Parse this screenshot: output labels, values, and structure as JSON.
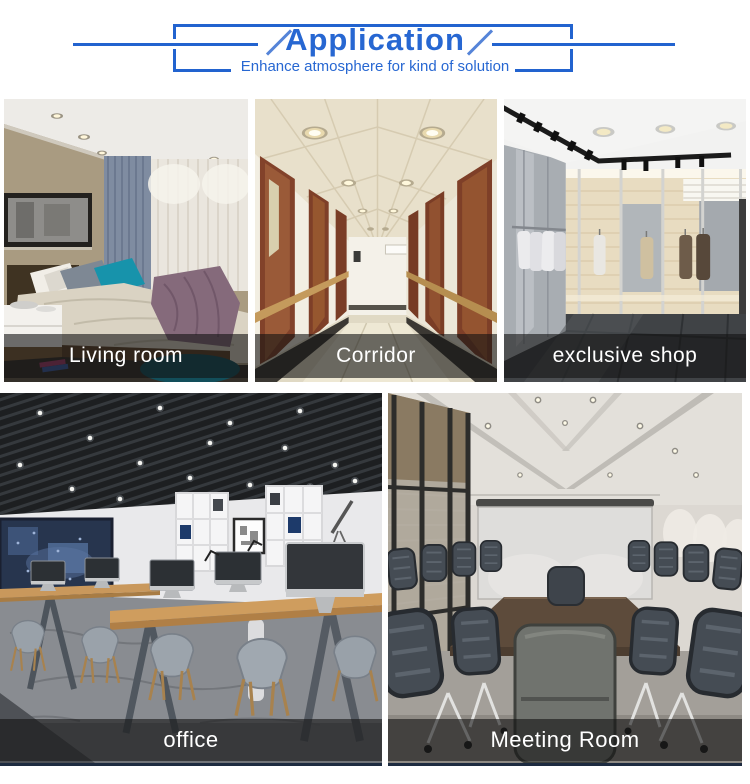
{
  "header": {
    "title": "Application",
    "subtitle": "Enhance atmosphere for kind of solution",
    "accent_color": "#2767d2"
  },
  "gallery": {
    "caption_text_color": "#ffffff",
    "caption_overlay_color": "rgba(18,18,18,0.6)",
    "items": [
      {
        "label": "Living room"
      },
      {
        "label": "Corridor"
      },
      {
        "label": "exclusive shop"
      },
      {
        "label": "office"
      },
      {
        "label": "Meeting Room"
      }
    ]
  }
}
